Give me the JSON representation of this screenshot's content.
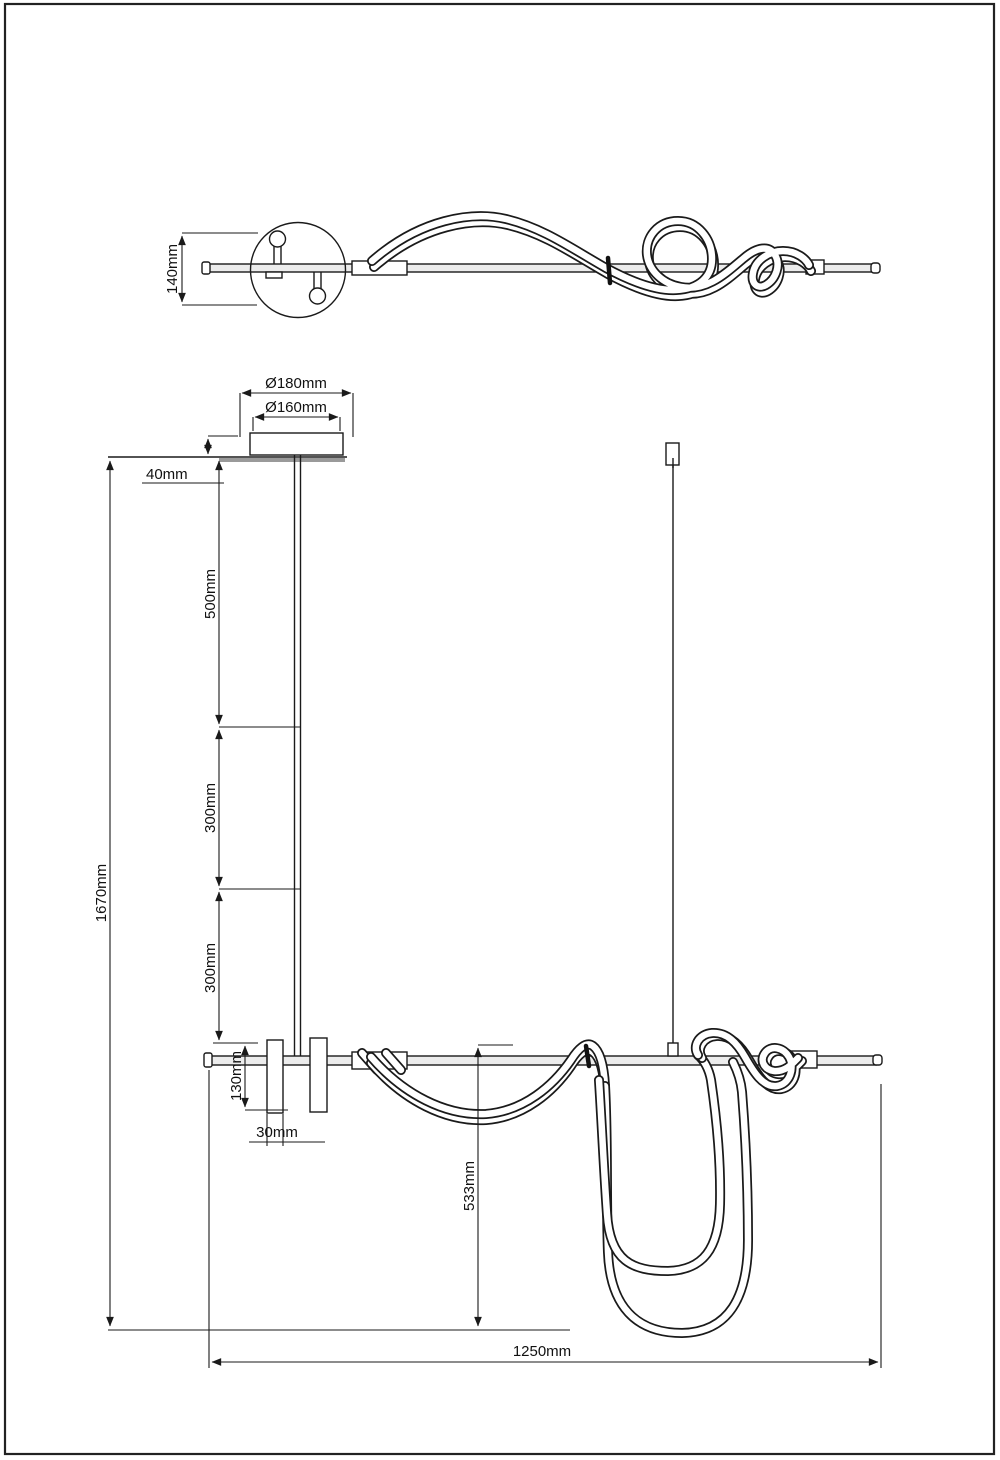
{
  "colors": {
    "line": "#1a1a1a",
    "background": "#ffffff",
    "bar_fill": "#ececec",
    "ceiling_shadow": "#9a9a9a"
  },
  "top_view": {
    "dim_depth": "140mm"
  },
  "front_view": {
    "dim_canopy_outer_diameter": "Ø180mm",
    "dim_canopy_inner_diameter": "Ø160mm",
    "dim_canopy_height": "40mm",
    "dim_rod_section_1": "500mm",
    "dim_rod_section_2": "300mm",
    "dim_rod_section_3": "300mm",
    "dim_total_height": "1670mm",
    "dim_connector_height": "130mm",
    "dim_connector_width": "30mm",
    "dim_tube_drop": "533mm",
    "dim_fixture_length": "1250mm"
  }
}
